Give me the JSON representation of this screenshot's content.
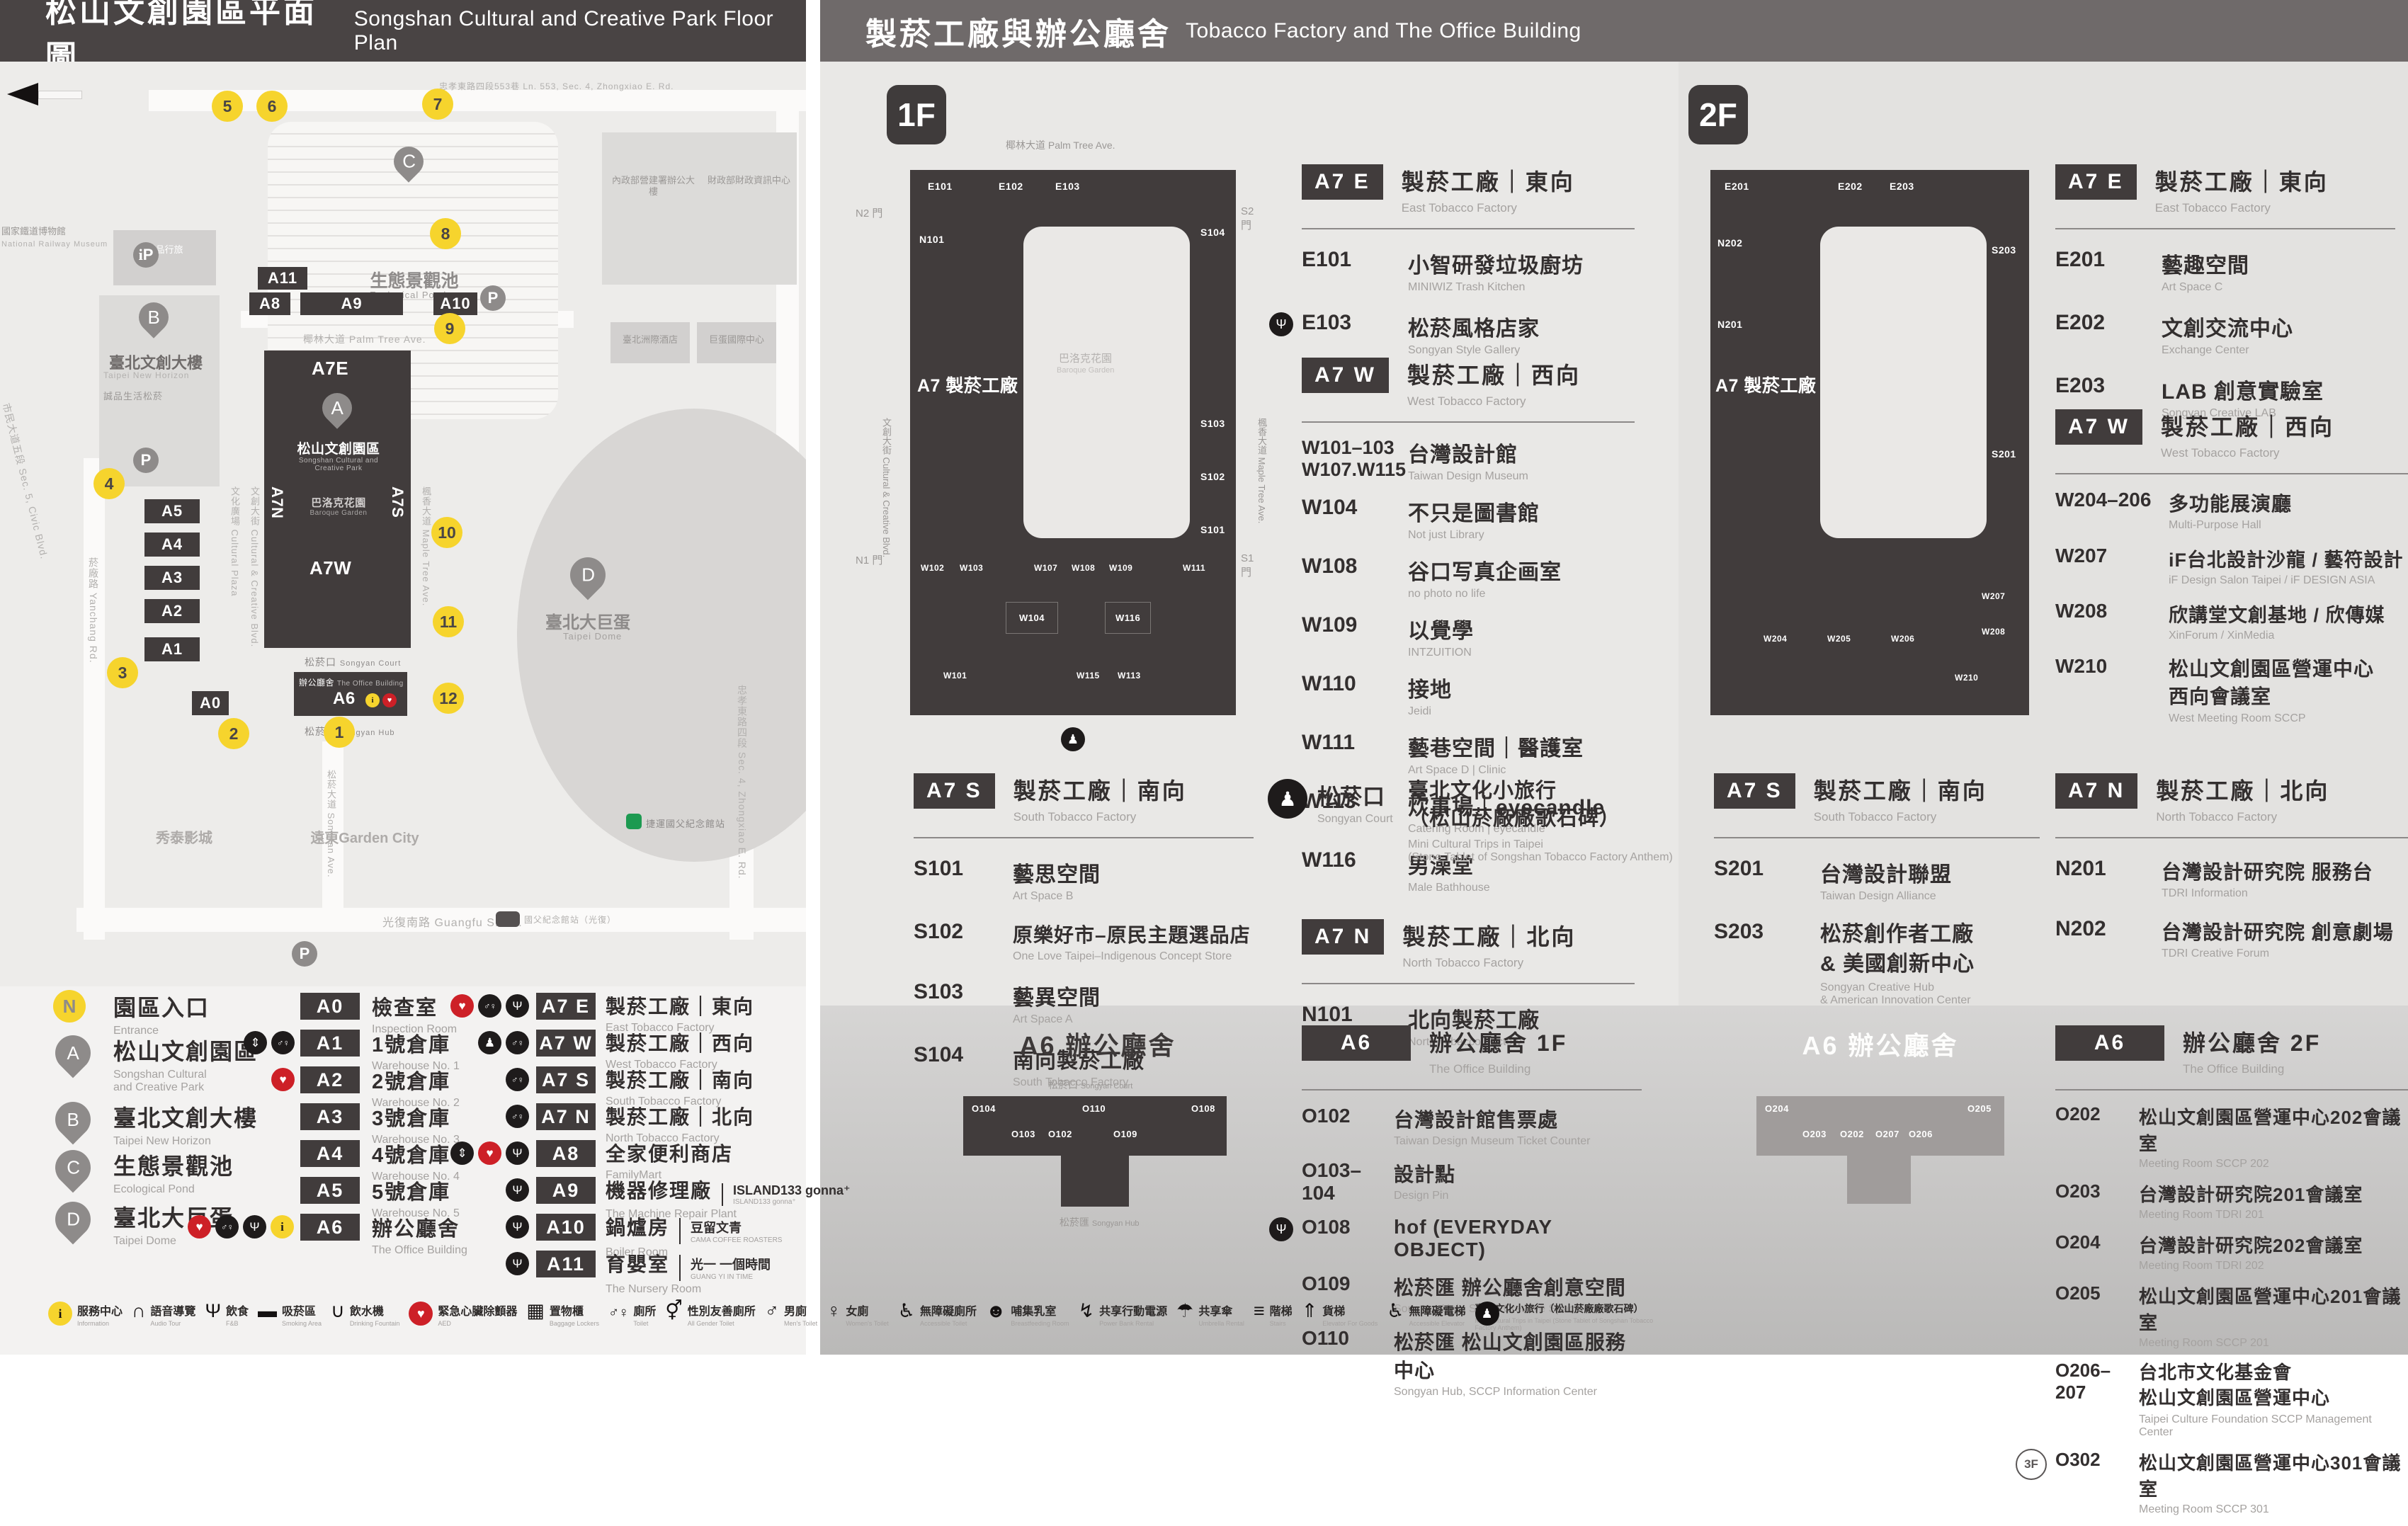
{
  "headers": {
    "left_zh": "松山文創園區平面圖",
    "left_en": "Songshan Cultural and Creative Park Floor Plan",
    "right_zh": "製菸工廠與辦公廳舍",
    "right_en": "Tobacco Factory and The Office Building"
  },
  "map": {
    "railway_zh": "國家鐵道博物館",
    "railway_en": "National Railway Museum",
    "lane553": "忠孝東路四段553巷 Ln. 553, Sec. 4, Zhongxiao E. Rd.",
    "gov1": "內政部營建署辦公大樓",
    "gov2": "財政部財政資訊中心",
    "hotel_icc": "臺北洲際酒店",
    "dome_intl": "巨蛋國際中心",
    "eslite_hotel": "誠品行旅",
    "eslite_hotel_en": "eslite hotel",
    "pond_zh": "生態景觀池",
    "pond_en": "Ecological Pond",
    "newhorizon_zh": "臺北文創大樓",
    "newhorizon_en": "Taipei New Horizon",
    "eslite_mall": "誠品生活松菸",
    "palm": "椰林大道 Palm Tree Ave.",
    "cultural_plaza": "文化廣場 Cultural Plaza",
    "cc_blvd": "文創大街 Cultural & Creative Blvd.",
    "maple": "楓香大道 Maple Tree Ave.",
    "yanchang": "菸廠路 Yanchang Rd.",
    "civic": "市民大道五段 Sec. 5, Civic Blvd.",
    "songyan_ave": "松菸大道 Songyan Ave.",
    "guangfu": "光復南路 Guangfu S. Rd.",
    "zhongxiao": "忠孝東路四段 Sec. 4, Zhongxiao E. Rd.",
    "park_zh": "松山文創園區",
    "park_en": "Songshan Cultural and\nCreative Park",
    "baroque_zh": "巴洛克花園",
    "baroque_en": "Baroque Garden",
    "court_zh": "松菸口",
    "court_en": "Songyan Court",
    "office_zh": "辦公廳舍",
    "office_en": "The Office Building",
    "hub_zh": "松菸匯",
    "hub_en": "Songyan Hub",
    "dome_zh": "臺北大巨蛋",
    "dome_en": "Taipei Dome",
    "showtime": "秀泰影城",
    "garden_city": "遠東Garden City",
    "mrt": "捷運國父紀念館站",
    "bus_stop": "國父紀念館站（光復）",
    "tags": {
      "a11": "A11",
      "a8": "A8",
      "a9": "A9",
      "a10": "A10",
      "a7e": "A7E",
      "a7n": "A7N",
      "a7s": "A7S",
      "a7w": "A7W",
      "a6": "A6",
      "a5": "A5",
      "a4": "A4",
      "a3": "A3",
      "a2": "A2",
      "a1": "A1",
      "a0": "A0"
    },
    "pins": {
      "a": "A",
      "b": "B",
      "c": "C",
      "d": "D"
    },
    "markers": [
      "1",
      "2",
      "3",
      "4",
      "5",
      "6",
      "7",
      "8",
      "9",
      "10",
      "11",
      "12"
    ]
  },
  "legend": {
    "entrance_badge": "N",
    "entrance_zh": "園區入口",
    "entrance_en": "Entrance",
    "pins": [
      {
        "letter": "A",
        "zh": "松山文創園區",
        "en": "Songshan Cultural\nand Creative Park"
      },
      {
        "letter": "B",
        "zh": "臺北文創大樓",
        "en": "Taipei New Horizon"
      },
      {
        "letter": "C",
        "zh": "生態景觀池",
        "en": "Ecological Pond"
      },
      {
        "letter": "D",
        "zh": "臺北大巨蛋",
        "en": "Taipei Dome"
      }
    ],
    "zones_a": [
      {
        "tag": "A0",
        "zh": "檢查室",
        "en": "Inspection Room",
        "icons": []
      },
      {
        "tag": "A1",
        "zh": "1號倉庫",
        "en": "Warehouse No. 1",
        "icons": [
          "elevator",
          "toilet"
        ]
      },
      {
        "tag": "A2",
        "zh": "2號倉庫",
        "en": "Warehouse No. 2",
        "icons": [
          "aed"
        ]
      },
      {
        "tag": "A3",
        "zh": "3號倉庫",
        "en": "Warehouse No. 3",
        "icons": []
      },
      {
        "tag": "A4",
        "zh": "4號倉庫",
        "en": "Warehouse No. 4",
        "icons": []
      },
      {
        "tag": "A5",
        "zh": "5號倉庫",
        "en": "Warehouse No. 5",
        "icons": []
      },
      {
        "tag": "A6",
        "zh": "辦公廳舍",
        "en": "The Office Building",
        "icons": [
          "aed",
          "toilet",
          "restaurant",
          "info"
        ]
      }
    ],
    "zones_b": [
      {
        "tag": "A7 E",
        "zh": "製菸工廠｜東向",
        "en": "East Tobacco Factory",
        "icons": [
          "aed",
          "toilet",
          "restaurant"
        ]
      },
      {
        "tag": "A7 W",
        "zh": "製菸工廠｜西向",
        "en": "West Tobacco Factory",
        "icons": [
          "mini-trip",
          "toilet"
        ]
      },
      {
        "tag": "A7 S",
        "zh": "製菸工廠｜南向",
        "en": "South Tobacco Factory",
        "icons": [
          "toilet"
        ]
      },
      {
        "tag": "A7 N",
        "zh": "製菸工廠｜北向",
        "en": "North Tobacco Factory",
        "icons": [
          "toilet"
        ]
      },
      {
        "tag": "A8",
        "zh": "全家便利商店",
        "en": "FamilyMart",
        "icons": [
          "elevator",
          "aed",
          "restaurant"
        ]
      },
      {
        "tag": "A9",
        "zh": "機器修理廠",
        "sub": "ISLAND133 gonna⁺",
        "sub2": "ISLAND133 gonna⁺",
        "en": "The Machine Repair Plant",
        "icons": [
          "restaurant"
        ]
      },
      {
        "tag": "A10",
        "zh": "鍋爐房",
        "sub": "豆留文青",
        "sub2": "CAMA COFFEE ROASTERS",
        "en": "Boiler Room",
        "icons": [
          "restaurant"
        ]
      },
      {
        "tag": "A11",
        "zh": "育嬰室",
        "sub": "光一 一個時間",
        "sub2": "GUANG YI IN TIME",
        "en": "The Nursery Room",
        "icons": [
          "restaurant"
        ]
      }
    ]
  },
  "f1": {
    "badge": "1F",
    "plan": {
      "ave": "椰林大道 Palm Tree Ave.",
      "bldg": "A7 製菸工廠",
      "court_zh": "巴洛克花園",
      "court_en": "Baroque Garden",
      "gate_n2": "N2 門",
      "gate_s2": "S2 門",
      "gate_n1": "N1 門",
      "gate_s1": "S1 門",
      "street_left": "文創大街 Cultural & Creative Blvd.",
      "street_right": "楓香大道 Maple Tree Ave.",
      "rooms": {
        "e101": "E101",
        "e102": "E102",
        "e103": "E103",
        "n101": "N101",
        "s101": "S101",
        "s102": "S102",
        "s103": "S103",
        "s104": "S104",
        "w101": "W101",
        "w102": "W102",
        "w103": "W103",
        "w104": "W104",
        "w107": "W107",
        "w108": "W108",
        "w109": "W109",
        "w111": "W111",
        "w113": "W113",
        "w115": "W115",
        "w116": "W116"
      }
    },
    "a7e": {
      "badge": "A7 E",
      "zh": "製菸工廠｜東向",
      "en": "East Tobacco Factory",
      "items": [
        {
          "code": "E101",
          "zh": "小智研發垃圾廚坊",
          "en": "MINIWIZ Trash Kitchen"
        },
        {
          "code": "E103",
          "zh": "松菸風格店家",
          "en": "Songyan Style Gallery",
          "icon": "restaurant"
        }
      ]
    },
    "a7w": {
      "badge": "A7 W",
      "zh": "製菸工廠｜西向",
      "en": "West Tobacco Factory",
      "items": [
        {
          "code": "W101–103\nW107.W115",
          "zh": "台灣設計館",
          "en": "Taiwan Design Museum"
        },
        {
          "code": "W104",
          "zh": "不只是圖書館",
          "en": "Not just Library"
        },
        {
          "code": "W108",
          "zh": "谷口写真企画室",
          "en": "no photo no life"
        },
        {
          "code": "W109",
          "zh": "以覺學",
          "en": "INTZUITION"
        },
        {
          "code": "W110",
          "zh": "接地",
          "en": "Jeidi"
        },
        {
          "code": "W111",
          "zh": "藝巷空間｜醫護室",
          "en": "Art Space D | Clinic"
        },
        {
          "code": "W113",
          "zh": "炊事場｜eyecandle",
          "en": "Catering Room | eyecandle"
        },
        {
          "code": "W116",
          "zh": "男澡堂",
          "en": "Male Bathhouse"
        }
      ]
    },
    "a7s": {
      "badge": "A7 S",
      "zh": "製菸工廠｜南向",
      "en": "South Tobacco Factory",
      "items": [
        {
          "code": "S101",
          "zh": "藝思空間",
          "en": "Art Space B"
        },
        {
          "code": "S102",
          "zh": "原樂好市–原民主題選品店",
          "en": "One Love Taipei–Indigenous Concept Store"
        },
        {
          "code": "S103",
          "zh": "藝異空間",
          "en": "Art Space A"
        },
        {
          "code": "S104",
          "zh": "南向製菸工廠",
          "en": "South Tobacco Factory"
        }
      ]
    },
    "court": {
      "zh": "松菸口",
      "en": "Songyan Court",
      "item_zh": "臺北文化小旅行\n（松山菸廠廠歌石碑）",
      "item_en": "Mini Cultural Trips in Taipei\n(Stone Tablet of Songshan Tobacco Factory Anthem)"
    },
    "a7n": {
      "badge": "A7 N",
      "zh": "製菸工廠｜北向",
      "en": "North Tobacco Factory",
      "items": [
        {
          "code": "N101",
          "zh": "北向製菸工廠",
          "en": "North Tobacco Factory"
        }
      ]
    },
    "a6": {
      "badge": "A6",
      "zh": "辦公廳舍 1F",
      "en": "The Office Building",
      "plan_title": "A6 辦公廳舍",
      "plan_rooms": {
        "o104": "O104",
        "o103": "O103",
        "o102": "O102",
        "o110": "O110",
        "o109": "O109",
        "o108": "O108"
      },
      "items": [
        {
          "code": "O102",
          "zh": "台灣設計館售票處",
          "en": "Taiwan Design Museum Ticket Counter"
        },
        {
          "code": "O103–104",
          "zh": "設計點",
          "en": "Design Pin"
        },
        {
          "code": "O108",
          "zh": "hof (EVERYDAY OBJECT)",
          "en": "",
          "icon": "restaurant"
        },
        {
          "code": "O109",
          "zh": "松菸匯 辦公廳舍創意空間",
          "en": "Songyan Hub, SCCP Creative Space"
        },
        {
          "code": "O110",
          "zh": "松菸匯 松山文創園區服務中心",
          "en": "Songyan Hub, SCCP Information Center"
        }
      ]
    }
  },
  "f2": {
    "badge": "2F",
    "plan": {
      "bldg": "A7 製菸工廠",
      "rooms": {
        "e201": "E201",
        "e202": "E202",
        "e203": "E203",
        "n201": "N201",
        "n202": "N202",
        "s201": "S201",
        "s203": "S203",
        "w204": "W204",
        "w205": "W205",
        "w206": "W206",
        "w207": "W207",
        "w208": "W208",
        "w210": "W210"
      }
    },
    "a7e": {
      "badge": "A7 E",
      "zh": "製菸工廠｜東向",
      "en": "East Tobacco Factory",
      "items": [
        {
          "code": "E201",
          "zh": "藝趣空間",
          "en": "Art Space C"
        },
        {
          "code": "E202",
          "zh": "文創交流中心",
          "en": "Exchange Center"
        },
        {
          "code": "E203",
          "zh": "LAB 創意實驗室",
          "en": "Songyan Creative LAB"
        }
      ]
    },
    "a7w": {
      "badge": "A7 W",
      "zh": "製菸工廠｜西向",
      "en": "West Tobacco Factory",
      "items": [
        {
          "code": "W204–206",
          "zh": "多功能展演廳",
          "en": "Multi-Purpose Hall"
        },
        {
          "code": "W207",
          "zh": "iF台北設計沙龍 / 藝符設計",
          "en": "iF Design Salon Taipei / iF DESIGN ASIA"
        },
        {
          "code": "W208",
          "zh": "欣講堂文創基地 / 欣傳媒",
          "en": "XinForum / XinMedia"
        },
        {
          "code": "W210",
          "zh": "松山文創園區營運中心\n西向會議室",
          "en": "West Meeting Room SCCP"
        }
      ]
    },
    "a7s": {
      "badge": "A7 S",
      "zh": "製菸工廠｜南向",
      "en": "South Tobacco Factory",
      "items": [
        {
          "code": "S201",
          "zh": "台灣設計聯盟",
          "en": "Taiwan Design Alliance"
        },
        {
          "code": "S203",
          "zh": "松菸創作者工廠\n& 美國創新中心",
          "en": "Songyan Creative Hub\n& American Innovation Center"
        }
      ]
    },
    "a7n": {
      "badge": "A7 N",
      "zh": "製菸工廠｜北向",
      "en": "North Tobacco Factory",
      "items": [
        {
          "code": "N201",
          "zh": "台灣設計研究院 服務台",
          "en": "TDRI Information"
        },
        {
          "code": "N202",
          "zh": "台灣設計研究院 創意劇場",
          "en": "TDRI Creative Forum"
        }
      ]
    },
    "a6": {
      "badge": "A6",
      "zh": "辦公廳舍 2F",
      "en": "The Office Building",
      "plan_title": "A6 辦公廳舍",
      "plan_rooms": {
        "o204": "O204",
        "o203": "O203",
        "o202": "O202",
        "o207": "O207",
        "o206": "O206",
        "o205": "O205"
      },
      "items": [
        {
          "code": "O202",
          "zh": "松山文創園區營運中心202會議室",
          "en": "Meeting Room SCCP 202"
        },
        {
          "code": "O203",
          "zh": "台灣設計研究院201會議室",
          "en": "Meeting Room TDRI 201"
        },
        {
          "code": "O204",
          "zh": "台灣設計研究院202會議室",
          "en": "Meeting Room TDRI 202"
        },
        {
          "code": "O205",
          "zh": "松山文創園區營運中心201會議室",
          "en": "Meeting Room SCCP 201"
        },
        {
          "code": "O206–207",
          "zh": "台北市文化基金會\n松山文創園區營運中心",
          "en": "Taipei Culture Foundation SCCP Management Center"
        },
        {
          "code": "O302",
          "prefix": "3F",
          "zh": "松山文創園區營運中心301會議室",
          "en": "Meeting Room SCCP 301"
        }
      ]
    }
  },
  "footer": [
    {
      "icon": "info-icon",
      "zh": "服務中心",
      "en": "Information"
    },
    {
      "icon": "audio-tour-icon",
      "zh": "語音導覽",
      "en": "Audio Tour"
    },
    {
      "icon": "food-icon",
      "zh": "飲食",
      "en": "F&B"
    },
    {
      "icon": "smoking-area-icon",
      "zh": "吸菸區",
      "en": "Smoking Area"
    },
    {
      "icon": "drinking-fountain-icon",
      "zh": "飲水機",
      "en": "Drinking Fountain"
    },
    {
      "icon": "aed-icon",
      "zh": "緊急心臟除顫器",
      "en": "AED"
    },
    {
      "icon": "locker-icon",
      "zh": "置物櫃",
      "en": "Baggage Lockers"
    },
    {
      "icon": "toilet-icon",
      "zh": "廁所",
      "en": "Toilet"
    },
    {
      "icon": "all-gender-toilet-icon",
      "zh": "性別友善廁所",
      "en": "All Gender Toilet"
    },
    {
      "icon": "mens-toilet-icon",
      "zh": "男廁",
      "en": "Men's Toilet"
    },
    {
      "icon": "womens-toilet-icon",
      "zh": "女廁",
      "en": "Women's Toilet"
    },
    {
      "icon": "accessible-toilet-icon",
      "zh": "無障礙廁所",
      "en": "Accessible Toilet"
    },
    {
      "icon": "breastfeeding-icon",
      "zh": "哺集乳室",
      "en": "Breastfeeding Room"
    },
    {
      "icon": "power-bank-icon",
      "zh": "共享行動電源",
      "en": "Power Bank Rental"
    },
    {
      "icon": "umbrella-icon",
      "zh": "共享傘",
      "en": "Umbrella Rental"
    },
    {
      "icon": "stairs-icon",
      "zh": "階梯",
      "en": "Stairs"
    },
    {
      "icon": "goods-elevator-icon",
      "zh": "貨梯",
      "en": "Elevator For Goods"
    },
    {
      "icon": "accessible-elevator-icon",
      "zh": "無障礙電梯",
      "en": "Accessible Elevator"
    },
    {
      "icon": "mini-trip-icon",
      "zh": "臺北文化小旅行（松山菸廠廠歌石碑）",
      "en": "Mini Cultural Trips in Taipei  (Stone Tablet of Songshan Tobacco Factory Anthem)"
    }
  ]
}
